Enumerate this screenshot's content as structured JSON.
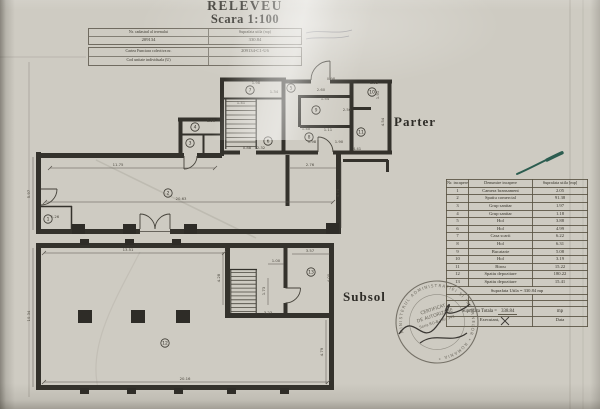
{
  "document": {
    "title": "RELEVEU",
    "scale": "Scara 1:100"
  },
  "header_table": {
    "col1_label": "Nr. cadastral al terenului",
    "col1_value": "209134",
    "col2_label": "Suprafata utila (mp)",
    "col2_value": "330.84",
    "row2_label": "Cartea Funciara colectiva nr.",
    "row2_value": "209134-C1-U6",
    "row3_label": "Cod unitate individuala (U)"
  },
  "floor_labels": {
    "upper": "Parter",
    "lower": "Subsol"
  },
  "rooms_table": {
    "headers": [
      "Nr. incapere",
      "Denumire incapere",
      "Suprafata utila [mp]"
    ],
    "rows": [
      [
        "1",
        "Camera bransament",
        "2.05"
      ],
      [
        "2",
        "Spatiu comercial",
        "91.38"
      ],
      [
        "3",
        "Grup sanitar",
        "1.97"
      ],
      [
        "4",
        "Grup sanitar",
        "1.18"
      ],
      [
        "5",
        "Hol",
        "3.88"
      ],
      [
        "6",
        "Hol",
        "4.99"
      ],
      [
        "7",
        "Casa scarii",
        "6.22"
      ],
      [
        "8",
        "Hol",
        "6.31"
      ],
      [
        "9",
        "Bucatarie",
        "5.08"
      ],
      [
        "10",
        "Hol",
        "3.19"
      ],
      [
        "11",
        "Birou",
        "15.22"
      ],
      [
        "12",
        "Spatiu depozitare",
        "180.22"
      ],
      [
        "13",
        "Spatiu depozitare",
        "15.41"
      ]
    ],
    "suprafata_utila": "Suprafata Utila = 330.84 mp",
    "totala_label": "Suprafata Totala =",
    "totala_value": "338.84",
    "totala_unit": "mp",
    "executant": "Executant,",
    "data": "Data"
  },
  "stamp": {
    "ring_text": "MINISTERUL ADMINISTRATIEI SI INTERNELOR * ROMANIA *",
    "lines": [
      "CERTIFICAT",
      "DE AUTORIZARE",
      "Seria RO-B-J Nr. 343"
    ]
  },
  "plan_annotations": {
    "parter_rooms": [
      {
        "n": "1",
        "x": 48,
        "y": 219
      },
      {
        "n": "2",
        "x": 168,
        "y": 193
      },
      {
        "n": "3",
        "x": 190,
        "y": 143
      },
      {
        "n": "4",
        "x": 195,
        "y": 127
      },
      {
        "n": "5",
        "x": 291,
        "y": 88
      },
      {
        "n": "6",
        "x": 268,
        "y": 141
      },
      {
        "n": "7",
        "x": 250,
        "y": 90
      },
      {
        "n": "8",
        "x": 309,
        "y": 137
      },
      {
        "n": "9",
        "x": 316,
        "y": 110
      },
      {
        "n": "10",
        "x": 372,
        "y": 92
      },
      {
        "n": "11",
        "x": 361,
        "y": 132
      }
    ],
    "subsol_rooms": [
      {
        "n": "12",
        "x": 165,
        "y": 343
      },
      {
        "n": "13",
        "x": 311,
        "y": 272
      }
    ],
    "parter_dims": [
      {
        "t": "11.75",
        "x": 118,
        "y": 166
      },
      {
        "t": "20.63",
        "x": 181,
        "y": 200
      },
      {
        "t": "5.97",
        "x": 30,
        "y": 194,
        "r": 1
      },
      {
        "t": "1.26",
        "x": 55,
        "y": 218
      },
      {
        "t": "1.98",
        "x": 256,
        "y": 84
      },
      {
        "t": "1.34",
        "x": 274,
        "y": 93
      },
      {
        "t": "1.41",
        "x": 241,
        "y": 104
      },
      {
        "t": "1.50",
        "x": 211,
        "y": 122
      },
      {
        "t": "2.60",
        "x": 321,
        "y": 91
      },
      {
        "t": "0.98",
        "x": 331,
        "y": 80
      },
      {
        "t": "1.54",
        "x": 325,
        "y": 100
      },
      {
        "t": "2.50",
        "x": 347,
        "y": 111
      },
      {
        "t": "1.40",
        "x": 306,
        "y": 130
      },
      {
        "t": "1.11",
        "x": 328,
        "y": 131
      },
      {
        "t": "1.98",
        "x": 312,
        "y": 143
      },
      {
        "t": "1.90",
        "x": 339,
        "y": 143
      },
      {
        "t": "1.52",
        "x": 374,
        "y": 84
      },
      {
        "t": "1.91",
        "x": 379,
        "y": 95,
        "r": 1
      },
      {
        "t": "4.54",
        "x": 384,
        "y": 122,
        "r": 1
      },
      {
        "t": "4.41",
        "x": 357,
        "y": 150
      },
      {
        "t": "2.76",
        "x": 310,
        "y": 166
      },
      {
        "t": "4.70",
        "x": 339,
        "y": 193,
        "r": 1
      },
      {
        "t": "0.88",
        "x": 247,
        "y": 149
      },
      {
        "t": "2.32",
        "x": 261,
        "y": 149
      }
    ],
    "subsol_dims": [
      {
        "t": "13.51",
        "x": 128,
        "y": 251
      },
      {
        "t": "20.16",
        "x": 185,
        "y": 380
      },
      {
        "t": "10.34",
        "x": 30,
        "y": 316,
        "r": 1
      },
      {
        "t": "4.79",
        "x": 323,
        "y": 352,
        "r": 1
      },
      {
        "t": "3.57",
        "x": 310,
        "y": 252
      },
      {
        "t": "4.00",
        "x": 330,
        "y": 278,
        "r": 1
      },
      {
        "t": "1.00",
        "x": 276,
        "y": 262
      },
      {
        "t": "1.73",
        "x": 265,
        "y": 291,
        "r": 1
      },
      {
        "t": "3.23",
        "x": 268,
        "y": 314
      },
      {
        "t": "4.28",
        "x": 220,
        "y": 278,
        "r": 1
      }
    ]
  }
}
